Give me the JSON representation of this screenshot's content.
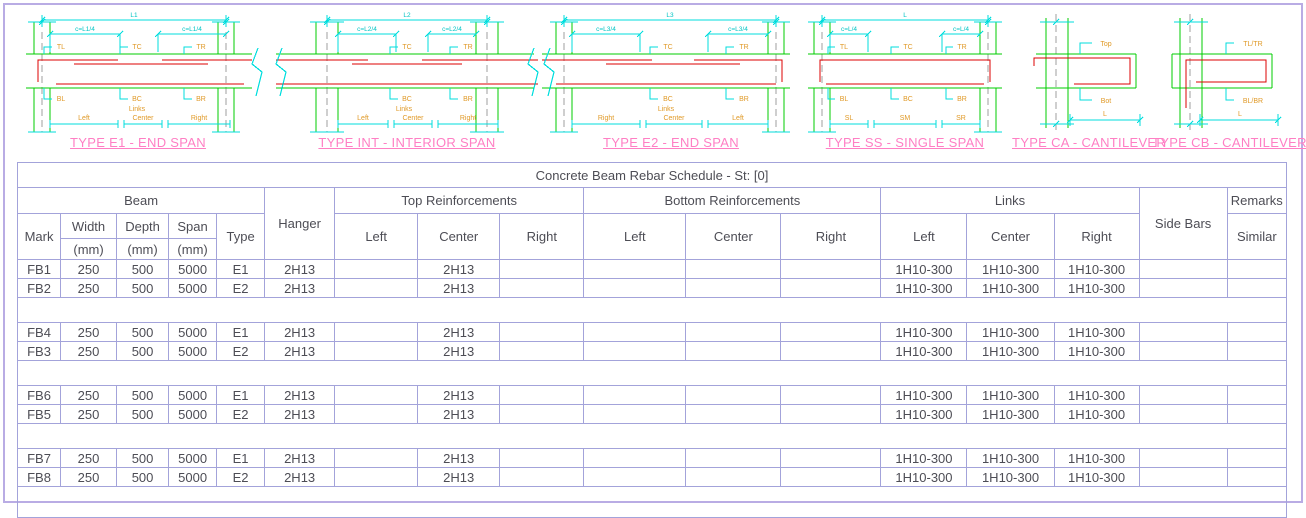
{
  "page": {
    "border_color": "#b9ace4",
    "grid_color": "#a3a3da",
    "dimension_color": "#00ffff",
    "concrete_color": "#00cc00",
    "rebar_color": "#dd0000",
    "label_color": "#e09a28",
    "caption_color": "#ff7fc4"
  },
  "diagrams": [
    {
      "caption": "TYPE E1 - END SPAN",
      "labels": {
        "span": "L1",
        "cut_left": "c=L1/4",
        "cut_right": "c=L1/4",
        "top_left": "TL",
        "top_center": "TC",
        "top_right": "TR",
        "bot_left": "BL",
        "bot_center": "BC",
        "bot_right": "BR",
        "links": "Links",
        "zone_left": "Left",
        "zone_center": "Center",
        "zone_right": "Right"
      }
    },
    {
      "caption": "TYPE INT - INTERIOR SPAN",
      "labels": {
        "span": "L2",
        "cut_left": "c=L2/4",
        "cut_right": "c=L2/4",
        "top_center": "TC",
        "top_right": "TR",
        "bot_center": "BC",
        "bot_right": "BR",
        "links": "Links",
        "zone_left": "Left",
        "zone_center": "Center",
        "zone_right": "Right"
      }
    },
    {
      "caption": "TYPE E2 - END SPAN",
      "labels": {
        "span": "L3",
        "cut_left": "c=L3/4",
        "cut_right": "c=L3/4",
        "top_center": "TC",
        "top_right": "TR",
        "bot_center": "BC",
        "bot_right": "BR",
        "links": "Links",
        "zone_left": "Right",
        "zone_center": "Center",
        "zone_right": "Left"
      }
    },
    {
      "caption": "TYPE SS - SINGLE SPAN",
      "labels": {
        "span": "L",
        "cut_left": "c=L/4",
        "cut_right": "c=L/4",
        "top_left": "TL",
        "top_center": "TC",
        "top_right": "TR",
        "bot_left": "BL",
        "bot_center": "BC",
        "bot_right": "BR",
        "zone_left": "SL",
        "zone_center": "SM",
        "zone_right": "SR"
      }
    },
    {
      "caption": "TYPE CA - CANTILEVER",
      "labels": {
        "top": "Top",
        "bot": "Bot",
        "span": "L"
      }
    },
    {
      "caption": "TYPE CB - CANTILEVER",
      "labels": {
        "top": "TL/TR",
        "bot": "BL/BR",
        "span": "L"
      }
    }
  ],
  "table": {
    "title": "Concrete Beam Rebar Schedule - St: [0]",
    "groups": {
      "beam": "Beam",
      "hanger": "Hanger",
      "top": "Top Reinforcements",
      "bottom": "Bottom Reinforcements",
      "links": "Links",
      "side_bars": "Side Bars",
      "remarks": "Remarks"
    },
    "columns": {
      "mark": "Mark",
      "width": "Width",
      "depth": "Depth",
      "span": "Span",
      "mm": "(mm)",
      "type": "Type",
      "left": "Left",
      "center": "Center",
      "right": "Right",
      "similar": "Similar"
    },
    "rows": [
      {
        "mark": "FB1",
        "width": "250",
        "depth": "500",
        "span": "5000",
        "type": "E1",
        "hanger": "2H13",
        "top_left": "",
        "top_center": "2H13",
        "top_right": "",
        "bot_left": "",
        "bot_center": "",
        "bot_right": "",
        "links_left": "1H10-300",
        "links_center": "1H10-300",
        "links_right": "1H10-300",
        "side_bars": "",
        "similar": ""
      },
      {
        "mark": "FB2",
        "width": "250",
        "depth": "500",
        "span": "5000",
        "type": "E2",
        "hanger": "2H13",
        "top_left": "",
        "top_center": "2H13",
        "top_right": "",
        "bot_left": "",
        "bot_center": "",
        "bot_right": "",
        "links_left": "1H10-300",
        "links_center": "1H10-300",
        "links_right": "1H10-300",
        "side_bars": "",
        "similar": ""
      },
      {
        "spacer": true
      },
      {
        "mark": "FB4",
        "width": "250",
        "depth": "500",
        "span": "5000",
        "type": "E1",
        "hanger": "2H13",
        "top_left": "",
        "top_center": "2H13",
        "top_right": "",
        "bot_left": "",
        "bot_center": "",
        "bot_right": "",
        "links_left": "1H10-300",
        "links_center": "1H10-300",
        "links_right": "1H10-300",
        "side_bars": "",
        "similar": ""
      },
      {
        "mark": "FB3",
        "width": "250",
        "depth": "500",
        "span": "5000",
        "type": "E2",
        "hanger": "2H13",
        "top_left": "",
        "top_center": "2H13",
        "top_right": "",
        "bot_left": "",
        "bot_center": "",
        "bot_right": "",
        "links_left": "1H10-300",
        "links_center": "1H10-300",
        "links_right": "1H10-300",
        "side_bars": "",
        "similar": ""
      },
      {
        "spacer": true
      },
      {
        "mark": "FB6",
        "width": "250",
        "depth": "500",
        "span": "5000",
        "type": "E1",
        "hanger": "2H13",
        "top_left": "",
        "top_center": "2H13",
        "top_right": "",
        "bot_left": "",
        "bot_center": "",
        "bot_right": "",
        "links_left": "1H10-300",
        "links_center": "1H10-300",
        "links_right": "1H10-300",
        "side_bars": "",
        "similar": ""
      },
      {
        "mark": "FB5",
        "width": "250",
        "depth": "500",
        "span": "5000",
        "type": "E2",
        "hanger": "2H13",
        "top_left": "",
        "top_center": "2H13",
        "top_right": "",
        "bot_left": "",
        "bot_center": "",
        "bot_right": "",
        "links_left": "1H10-300",
        "links_center": "1H10-300",
        "links_right": "1H10-300",
        "side_bars": "",
        "similar": ""
      },
      {
        "spacer": true
      },
      {
        "mark": "FB7",
        "width": "250",
        "depth": "500",
        "span": "5000",
        "type": "E1",
        "hanger": "2H13",
        "top_left": "",
        "top_center": "2H13",
        "top_right": "",
        "bot_left": "",
        "bot_center": "",
        "bot_right": "",
        "links_left": "1H10-300",
        "links_center": "1H10-300",
        "links_right": "1H10-300",
        "side_bars": "",
        "similar": ""
      },
      {
        "mark": "FB8",
        "width": "250",
        "depth": "500",
        "span": "5000",
        "type": "E2",
        "hanger": "2H13",
        "top_left": "",
        "top_center": "2H13",
        "top_right": "",
        "bot_left": "",
        "bot_center": "",
        "bot_right": "",
        "links_left": "1H10-300",
        "links_center": "1H10-300",
        "links_right": "1H10-300",
        "side_bars": "",
        "similar": ""
      },
      {
        "spacer": true
      }
    ]
  }
}
